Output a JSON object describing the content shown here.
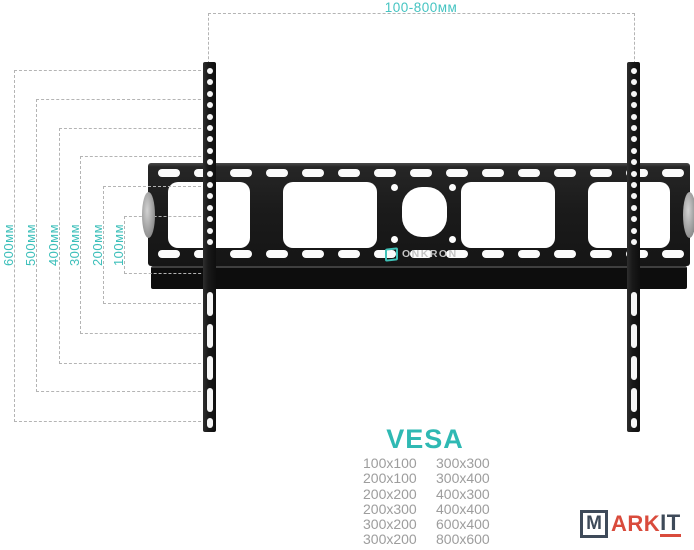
{
  "top_dimension": {
    "label": "100-800мм"
  },
  "side_dimensions": [
    "600мм",
    "500мм",
    "400мм",
    "300мм",
    "200мм",
    "100мм"
  ],
  "mount": {
    "brand": "ONKRON"
  },
  "vesa": {
    "heading": "VESA",
    "left_column": [
      "100x100",
      "200x100",
      "200x200",
      "200x300",
      "300x200",
      "300x200"
    ],
    "right_column": [
      "300x300",
      "300x400",
      "400x300",
      "400x400",
      "600x400",
      "800x600"
    ]
  },
  "watermark": {
    "boxed_letter": "M",
    "red_part": "ARK",
    "underlined_part": "IT"
  },
  "colors": {
    "accent_teal": "#3cbfba",
    "dashed_line": "#b4b4b4",
    "table_text": "#9d9d9d",
    "watermark_red": "#d94b3c",
    "watermark_navy": "#3e4a59"
  }
}
